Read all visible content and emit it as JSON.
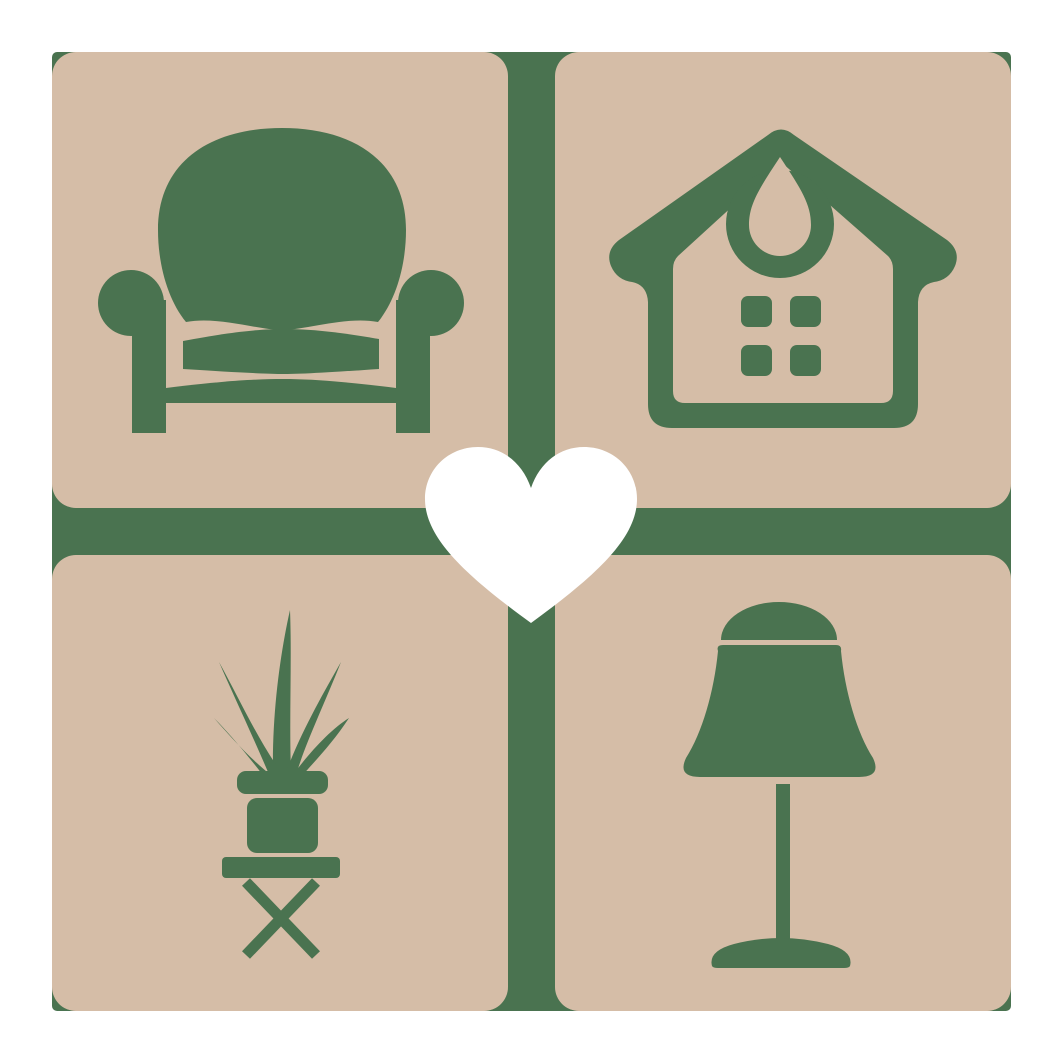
{
  "logo": {
    "name": "home-furniture-heart-logo",
    "center": {
      "icon": "heart-icon",
      "meaning": "heart"
    },
    "grid": {
      "rows": 2,
      "cols": 2,
      "tiles": [
        {
          "position": "top-left",
          "icon": "armchair-icon",
          "meaning": "armchair"
        },
        {
          "position": "top-right",
          "icon": "house-icon",
          "meaning": "house with round ornament and four-pane window"
        },
        {
          "position": "bottom-left",
          "icon": "potted-plant-icon",
          "meaning": "potted plant on x-leg stool"
        },
        {
          "position": "bottom-right",
          "icon": "table-lamp-icon",
          "meaning": "table lamp"
        }
      ]
    }
  },
  "colors": {
    "background": "#ffffff",
    "tile_tan": "#d5bda7",
    "icon_green": "#4a7350",
    "heart_white": "#ffffff"
  }
}
